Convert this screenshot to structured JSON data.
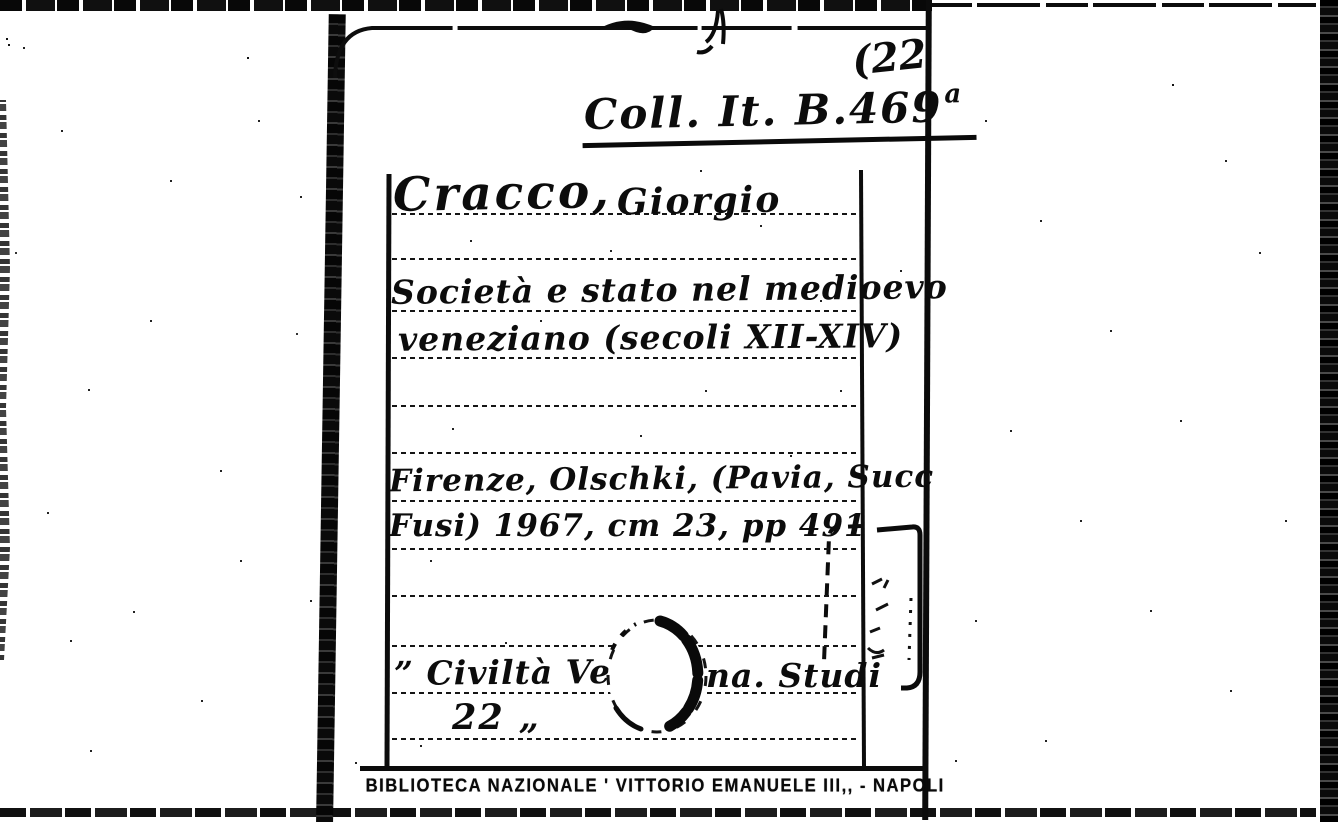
{
  "card": {
    "corner_number": "(22",
    "call_number": {
      "main": "Coll. It. B.469",
      "superscript": "a"
    },
    "author": {
      "surname": "Cracco,",
      "forename": "Giorgio"
    },
    "title": {
      "line1": "Società e stato nel medioevo",
      "line2": "veneziano (secoli XII-XIV)"
    },
    "imprint": {
      "line1": "Firenze, Olschki, (Pavia, Succ",
      "line2": "Fusi) 1967, cm 23, pp 491"
    },
    "series": {
      "line1_left": "” Civiltà Ve",
      "line1_right": "na. Studi",
      "line2": "22 „"
    },
    "stamp": "BIBLIOTECA NAZIONALE ' VITTORIO EMANUELE III,, - NAPOLI"
  },
  "colors": {
    "ink": "#0b0b0b",
    "paper": "#ffffff"
  }
}
